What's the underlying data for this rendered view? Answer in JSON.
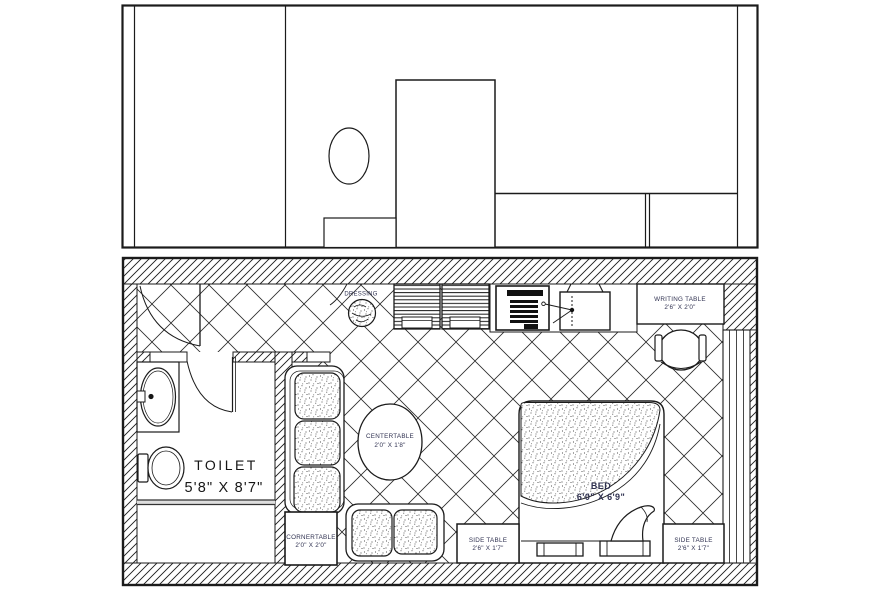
{
  "meta": {
    "drawing_type": "hotel guest room furniture layout plan with elevation",
    "background_color": "#ffffff",
    "line_color": "#1b1b1b",
    "label_color": "#2f3150"
  },
  "plan": {
    "dressing": {
      "label": "DRESSING"
    },
    "writing_table": {
      "line1": "WRITING TABLE",
      "line2": "2'6\" X 2'0\""
    },
    "center_table": {
      "line1": "CENTERTABLE",
      "line2": "2'0\" X 1'8\""
    },
    "corner_table": {
      "line1": "CORNERTABLE",
      "line2": "2'0\" X 2'0\""
    },
    "side_table_left": {
      "line1": "SIDE TABLE",
      "line2": "2'6\" X 1'7\""
    },
    "side_table_right": {
      "line1": "SIDE TABLE",
      "line2": "2'6\" X 1'7\""
    },
    "bed": {
      "line1": "BED",
      "line2": "6'0\" X 6'9\""
    },
    "toilet": {
      "line1": "TOILET",
      "line2": "5'8\" X 8'7\""
    }
  }
}
